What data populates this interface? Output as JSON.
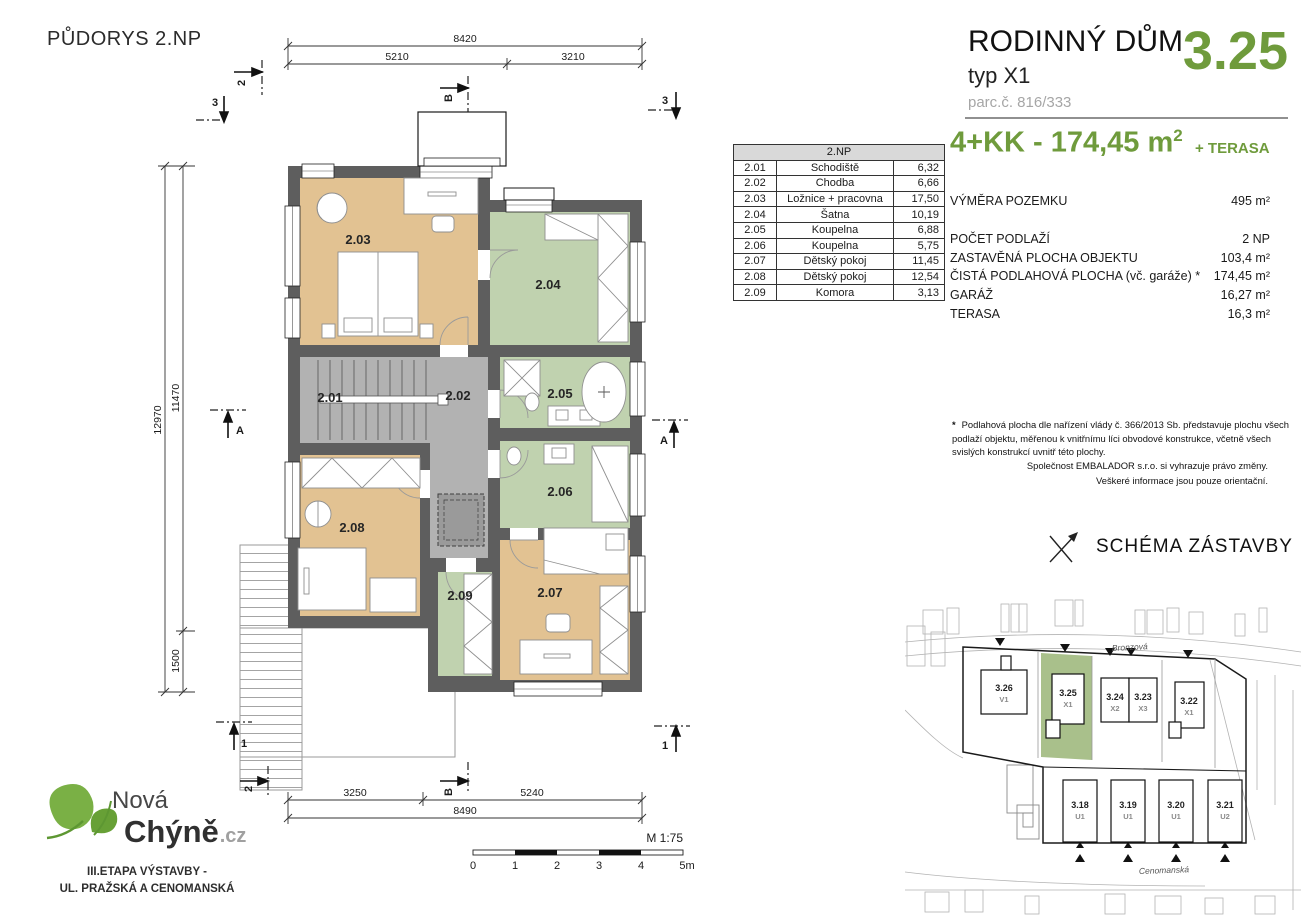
{
  "colors": {
    "brand_green": "#6f9b3c",
    "room_tan": "#e2c292",
    "room_green": "#c0d2af",
    "room_gray": "#b2b2b2",
    "wall_gray": "#5e5e5e",
    "parcel_green": "#a9c08b"
  },
  "plan": {
    "title": "PŮDORYS 2.NP",
    "room_labels": [
      "2.01",
      "2.02",
      "2.03",
      "2.04",
      "2.05",
      "2.06",
      "2.07",
      "2.08",
      "2.09"
    ],
    "dims": {
      "top_total": "8420",
      "top_left": "5210",
      "top_right": "3210",
      "left_total": "12970",
      "left_upper": "11470",
      "left_lower": "1500",
      "bottom_left": "3250",
      "bottom_right": "5240",
      "bottom_total": "8490"
    },
    "markers": {
      "sec2": "2",
      "secB": "B",
      "sec3": "3",
      "secA": "A",
      "sec1": "1"
    },
    "scale": {
      "label": "M 1:75",
      "t0": "0",
      "t1": "1",
      "t2": "2",
      "t3": "3",
      "t4": "4",
      "t5": "5m"
    }
  },
  "room_table": {
    "header": "2.NP",
    "rows": [
      {
        "id": "2.01",
        "name": "Schodiště",
        "area": "6,32"
      },
      {
        "id": "2.02",
        "name": "Chodba",
        "area": "6,66"
      },
      {
        "id": "2.03",
        "name": "Ložnice + pracovna",
        "area": "17,50"
      },
      {
        "id": "2.04",
        "name": "Šatna",
        "area": "10,19"
      },
      {
        "id": "2.05",
        "name": "Koupelna",
        "area": "6,88"
      },
      {
        "id": "2.06",
        "name": "Koupelna",
        "area": "5,75"
      },
      {
        "id": "2.07",
        "name": "Dětský pokoj",
        "area": "11,45"
      },
      {
        "id": "2.08",
        "name": "Dětský pokoj",
        "area": "12,54"
      },
      {
        "id": "2.09",
        "name": "Komora",
        "area": "3,13"
      }
    ]
  },
  "info_panel": {
    "title": "RODINNÝ DŮM",
    "subtitle": "typ X1",
    "parcel": "parc.č. 816/333",
    "number": "3.25",
    "size_main": "4+KK - 174,45 m",
    "size_sup": "2",
    "terrace_note": "+ TERASA",
    "specs": [
      {
        "label": "VÝMĚRA POZEMKU",
        "value": "495 m²"
      },
      {
        "label": "POČET PODLAŽÍ",
        "value": "2 NP"
      },
      {
        "label": "ZASTAVĚNÁ PLOCHA OBJEKTU",
        "value": "103,4 m²"
      },
      {
        "label": "ČISTÁ PODLAHOVÁ PLOCHA (vč. garáže) *",
        "value": "174,45 m²"
      },
      {
        "label": "GARÁŽ",
        "value": "16,27 m²"
      },
      {
        "label": "TERASA",
        "value": "16,3 m²"
      }
    ],
    "footnote_star": "*",
    "footnote": "Podlahová plocha dle nařízení vlády č. 366/2013 Sb. představuje plochu všech podlaží objektu, měřenou k vnitřnímu líci obvodové konstrukce, včetně všech svislých konstrukcí uvnitř této plochy.",
    "disclaimer1": "Společnost EMBALADOR s.r.o. si vyhrazuje právo změny.",
    "disclaimer2": "Veškeré informace jsou pouze orientační."
  },
  "schema": {
    "title": "SCHÉMA ZÁSTAVBY",
    "street_top": "Bronzová",
    "street_bottom": "Cenomanská",
    "top_houses": [
      {
        "id": "3.26",
        "type": "V1"
      },
      {
        "id": "3.25",
        "type": "X1"
      },
      {
        "id": "3.24",
        "type": "X2"
      },
      {
        "id": "3.23",
        "type": "X3"
      },
      {
        "id": "3.22",
        "type": "X1"
      }
    ],
    "bottom_houses": [
      {
        "id": "3.18",
        "type": "U1"
      },
      {
        "id": "3.19",
        "type": "U1"
      },
      {
        "id": "3.20",
        "type": "U1"
      },
      {
        "id": "3.21",
        "type": "U2"
      }
    ]
  },
  "logo": {
    "line1": "Nová",
    "line2": "Chýně",
    "tld": ".cz",
    "tagline1": "III.ETAPA VÝSTAVBY -",
    "tagline2": "UL. PRAŽSKÁ A CENOMANSKÁ"
  }
}
